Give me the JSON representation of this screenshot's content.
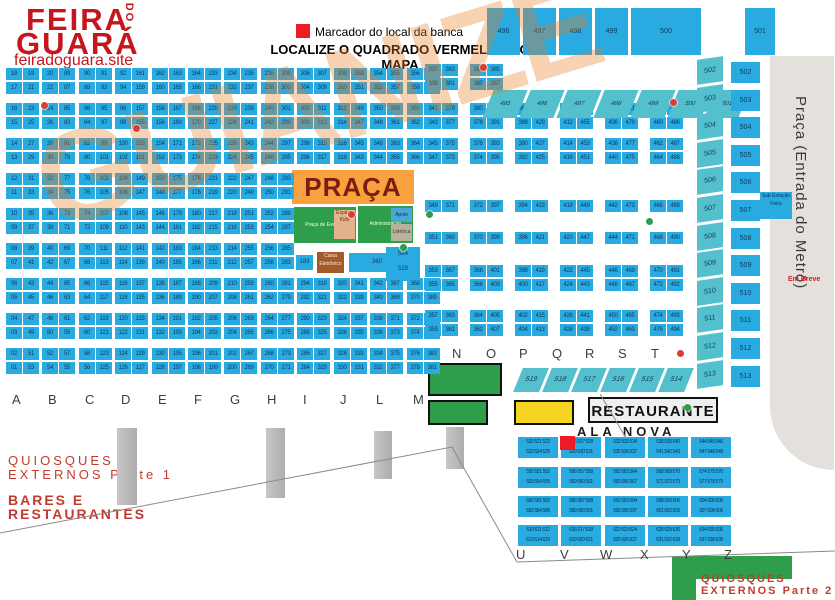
{
  "logo": {
    "line1": "FEIRA",
    "do_word": "DO",
    "line2": "GUARÁ",
    "site": "feiradoguara.site"
  },
  "legend": {
    "marker_label": "Marcador do local da banca",
    "headline": "LOCALIZE O QUADRADO VERMELHO NO MAPA"
  },
  "colors": {
    "stall_blue": "#29abe2",
    "teal": "#54c0cd",
    "praca_orange": "#f8a13e",
    "green": "#2f9e4b",
    "yellow": "#f4d522",
    "marker_red": "#ed1c24",
    "logo_red": "#c4161c",
    "footer_red": "#c23b2e",
    "metro_gray": "#e4e1dc"
  },
  "left_grid": {
    "block_ys": [
      68,
      103,
      138,
      173,
      208,
      243,
      278,
      313,
      348
    ],
    "letters_y": 392,
    "columns": [
      {
        "letter": "A",
        "x": 6,
        "split": false,
        "left": [
          "18",
          "17",
          "16",
          "15",
          "14",
          "13",
          "12",
          "11",
          "10",
          "09",
          "08",
          "07",
          "06",
          "05",
          "04",
          "03",
          "02",
          "01"
        ],
        "right": [
          "19",
          "21",
          "23",
          "25",
          "27",
          "29",
          "31",
          "33",
          "35",
          "37",
          "39",
          "41",
          "43",
          "45",
          "47",
          "49",
          "51",
          "53"
        ]
      },
      {
        "letter": "B",
        "x": 42,
        "split": false,
        "left": [
          "20",
          "22",
          "24",
          "26",
          "28",
          "30",
          "32",
          "34",
          "36",
          "38",
          "40",
          "42",
          "44",
          "46",
          "48",
          "50",
          "52",
          "54"
        ],
        "right": [
          "89",
          "87",
          "85",
          "83",
          "81",
          "79",
          "77",
          "75",
          "73",
          "71",
          "69",
          "67",
          "65",
          "63",
          "61",
          "59",
          "57",
          "55"
        ]
      },
      {
        "letter": "C",
        "x": 79,
        "split": false,
        "left": [
          "90",
          "88",
          "86",
          "84",
          "82",
          "80",
          "78",
          "76",
          "74",
          "72",
          "70",
          "68",
          "66",
          "64",
          "62",
          "60",
          "58",
          "56"
        ],
        "right": [
          "91",
          "93",
          "95",
          "97",
          "99",
          "101",
          "103",
          "105",
          "107",
          "109",
          "111",
          "113",
          "115",
          "117",
          "119",
          "121",
          "123",
          "125"
        ]
      },
      {
        "letter": "D",
        "x": 115,
        "split": false,
        "left": [
          "92",
          "94",
          "96",
          "98",
          "100",
          "102",
          "104",
          "106",
          "108",
          "110",
          "112",
          "114",
          "116",
          "118",
          "120",
          "122",
          "124",
          "126"
        ],
        "right": [
          "161",
          "159",
          "157",
          "155",
          "153",
          "151",
          "149",
          "147",
          "145",
          "143",
          "141",
          "139",
          "137",
          "135",
          "133",
          "131",
          "129",
          "127"
        ]
      },
      {
        "letter": "E",
        "x": 152,
        "split": false,
        "left": [
          "162",
          "160",
          "158",
          "156",
          "154",
          "152",
          "150",
          "148",
          "146",
          "144",
          "142",
          "140",
          "138",
          "136",
          "134",
          "132",
          "130",
          "128"
        ],
        "right": [
          "163",
          "165",
          "167",
          "169",
          "171",
          "173",
          "175",
          "177",
          "179",
          "181",
          "183",
          "185",
          "187",
          "189",
          "191",
          "193",
          "195",
          "197"
        ]
      },
      {
        "letter": "F",
        "x": 188,
        "split": false,
        "left": [
          "164",
          "166",
          "168",
          "170",
          "172",
          "174",
          "176",
          "178",
          "180",
          "182",
          "184",
          "186",
          "188",
          "190",
          "192",
          "194",
          "196",
          "198"
        ],
        "right": [
          "233",
          "231",
          "229",
          "227",
          "225",
          "223",
          "221",
          "219",
          "217",
          "215",
          "213",
          "211",
          "209",
          "207",
          "205",
          "203",
          "201",
          "199"
        ]
      },
      {
        "letter": "G",
        "x": 224,
        "split": false,
        "left": [
          "234",
          "232",
          "230",
          "228",
          "226",
          "224",
          "222",
          "220",
          "218",
          "216",
          "214",
          "212",
          "210",
          "208",
          "206",
          "204",
          "202",
          "200"
        ],
        "right": [
          "235",
          "237",
          "239",
          "241",
          "243",
          "245",
          "247",
          "249",
          "251",
          "253",
          "255",
          "257",
          "259",
          "261",
          "263",
          "265",
          "267",
          "269"
        ]
      },
      {
        "letter": "H",
        "x": 261,
        "split": false,
        "left": [
          "236",
          "238",
          "240",
          "242",
          "244",
          "246",
          "248",
          "250",
          "252",
          "254",
          "256",
          "258",
          "260",
          "262",
          "264",
          "266",
          "268",
          "270"
        ],
        "right": [
          "305",
          "303",
          "301",
          "299",
          "297",
          "295",
          "293",
          "291",
          "289",
          "287",
          "285",
          "283",
          "281",
          "279",
          "277",
          "275",
          "273",
          "271"
        ]
      },
      {
        "letter": "I",
        "x": 297,
        "split": true,
        "left": [
          "306",
          "304",
          "302",
          "300",
          "298",
          "296",
          "294",
          "292",
          "290",
          "288",
          "286",
          "284"
        ],
        "right": [
          "307",
          "309",
          "311",
          "313",
          "315",
          "317",
          "319",
          "321",
          "323",
          "325",
          "327",
          "329"
        ]
      },
      {
        "letter": "J",
        "x": 334,
        "split": true,
        "left": [
          "308",
          "310",
          "312",
          "314",
          "316",
          "318",
          "320",
          "322",
          "324",
          "326",
          "328",
          "330"
        ],
        "right": [
          "353",
          "351",
          "349",
          "347",
          "345",
          "343",
          "341",
          "339",
          "337",
          "335",
          "333",
          "331"
        ]
      },
      {
        "letter": "L",
        "x": 370,
        "split": true,
        "left": [
          "354",
          "352",
          "350",
          "348",
          "346",
          "344",
          "342",
          "340",
          "338",
          "336",
          "334",
          "332"
        ],
        "right": [
          "355",
          "357",
          "359",
          "361",
          "363",
          "365",
          "367",
          "369",
          "371",
          "373",
          "375",
          "377"
        ]
      },
      {
        "letter": "M",
        "x": 407,
        "split": true,
        "left": [
          "356",
          "358",
          "360",
          "362",
          "364",
          "366",
          "368",
          "370",
          "372",
          "374",
          "376",
          "378"
        ],
        "right": [
          "403",
          "401",
          "399",
          "397",
          "395",
          "393",
          "391",
          "389",
          "387",
          "385",
          "383",
          "381"
        ]
      }
    ]
  },
  "center_grid": {
    "rows_full": [
      64,
      78,
      103,
      117,
      138,
      152,
      200,
      232,
      265,
      279,
      310,
      324
    ],
    "rows_short": [
      103,
      117,
      138,
      152,
      200,
      232,
      265,
      279,
      310,
      324
    ],
    "letters": [
      "N",
      "O",
      "P",
      "Q",
      "R",
      "S",
      "T"
    ],
    "letters_y": 346,
    "columns": [
      {
        "x": 425,
        "size": "full",
        "left": [
          "337",
          "339",
          "341",
          "343",
          "345",
          "347",
          "349",
          "351",
          "353",
          "355",
          "357",
          "359"
        ],
        "right": [
          "383",
          "381",
          "379",
          "377",
          "375",
          "373",
          "371",
          "369",
          "367",
          "365",
          "363",
          "361"
        ]
      },
      {
        "x": 470,
        "size": "full",
        "left": [
          "384",
          "382",
          "380",
          "378",
          "376",
          "374",
          "372",
          "370",
          "368",
          "366",
          "364",
          "362"
        ],
        "right": [
          "385",
          "387",
          "389",
          "391",
          "393",
          "395",
          "397",
          "399",
          "401",
          "403",
          "405",
          "407"
        ]
      },
      {
        "x": 515,
        "size": "short",
        "left": [
          "386",
          "388",
          "390",
          "392",
          "394",
          "396",
          "398",
          "400",
          "402",
          "404"
        ],
        "right": [
          "431",
          "429",
          "427",
          "425",
          "423",
          "421",
          "419",
          "417",
          "415",
          "413"
        ]
      },
      {
        "x": 560,
        "size": "short",
        "left": [
          "410",
          "412",
          "414",
          "416",
          "418",
          "420",
          "422",
          "424",
          "426",
          "428"
        ],
        "right": [
          "457",
          "455",
          "453",
          "451",
          "449",
          "447",
          "445",
          "443",
          "441",
          "439"
        ]
      },
      {
        "x": 605,
        "size": "short",
        "left": [
          "434",
          "436",
          "438",
          "440",
          "442",
          "444",
          "446",
          "448",
          "450",
          "452"
        ],
        "right": [
          "481",
          "479",
          "477",
          "475",
          "473",
          "471",
          "469",
          "467",
          "465",
          "463"
        ]
      },
      {
        "x": 650,
        "size": "short",
        "left": [
          "458",
          "460",
          "462",
          "464",
          "466",
          "468",
          "470",
          "472",
          "474",
          "476"
        ],
        "right": [
          "485",
          "486",
          "487",
          "488",
          "489",
          "490",
          "491",
          "492",
          "493",
          "494"
        ]
      }
    ]
  },
  "top_strip": {
    "boxes": [
      "496",
      "497",
      "498",
      "499"
    ],
    "wide_box": "500",
    "tall_box": "501",
    "slanted": [
      "495",
      "496",
      "497",
      "498",
      "499",
      "500",
      "501"
    ]
  },
  "right_strips": {
    "slanted": [
      "502",
      "503",
      "504",
      "505",
      "506",
      "507",
      "508",
      "509",
      "510",
      "511",
      "512",
      "513"
    ],
    "rects": [
      "502",
      "503",
      "504",
      "505",
      "506",
      "507",
      "508",
      "509",
      "510",
      "511",
      "512",
      "513"
    ]
  },
  "mid_strip": [
    "519",
    "518",
    "517",
    "516",
    "515",
    "514"
  ],
  "metro": {
    "label": "Praça (Entrada do Metrô)",
    "em_breve": "Em Breve",
    "substation": "Sub Estação Feira"
  },
  "praca": {
    "title": "PRAÇA",
    "events_label": "Praça de Eventos",
    "kids_label": "Espaço Kids",
    "admin_label": "Administração",
    "apoio_label": "Apoio",
    "loterica_label": "Lotérica",
    "caixa_label": "Caixa Eletrônico",
    "box_a": "183",
    "box_b": "360",
    "box_c1": "524",
    "box_c2": "528"
  },
  "restaurante": {
    "label": "RESTAURANTE"
  },
  "ala_nova": {
    "title": "ALA NOVA",
    "letters": [
      "U",
      "V",
      "W",
      "X",
      "Y",
      "Z"
    ],
    "letters_y": 547,
    "col_xs": [
      518,
      561,
      605,
      648,
      691
    ],
    "row_ys": [
      437,
      467,
      496,
      525
    ],
    "boxes": [
      [
        [
          "520 521 522",
          "523 524 525"
        ],
        [
          "526 527 528",
          "529 530 531"
        ],
        [
          "532 533 534",
          "535 536 537"
        ],
        [
          "538 539 540",
          "541 542 543"
        ],
        [
          "544 545 546",
          "547 548 549"
        ]
      ],
      [
        [
          "550 551 552",
          "553 554 555"
        ],
        [
          "556 557 558",
          "559 560 561"
        ],
        [
          "562 563 564",
          "565 566 567"
        ],
        [
          "568 569 570",
          "571 572 573"
        ],
        [
          "574 575 576",
          "577 578 579"
        ]
      ],
      [
        [
          "580 581 582",
          "583 584 585"
        ],
        [
          "586 587 588",
          "589 590 591"
        ],
        [
          "592 593 594",
          "595 596 597"
        ],
        [
          "598 599 600",
          "601 602 603"
        ],
        [
          "604 605 606",
          "607 608 609"
        ]
      ],
      [
        [
          "610 611 612",
          "613 614 615"
        ],
        [
          "616 617 618",
          "619 620 621"
        ],
        [
          "622 623 624",
          "625 626 627"
        ],
        [
          "628 629 630",
          "631 632 633"
        ],
        [
          "634 635 636",
          "637 638 639"
        ]
      ]
    ]
  },
  "footer": {
    "q1_line1": "QUIOSQUES",
    "q1_line2": "EXTERNOS Parte 1",
    "bares_line1": "BARES E",
    "bares_line2": "RESTAURANTES",
    "q2_line1": "QUIOSQUES",
    "q2_line2": "EXTERNOS Parte 2"
  },
  "watermark": {
    "text": "GUIANIZE"
  },
  "dots": [
    {
      "x": 41,
      "y": 102,
      "color": "#e03c2f"
    },
    {
      "x": 133,
      "y": 125,
      "color": "#e03c2f"
    },
    {
      "x": 480,
      "y": 64,
      "color": "#e03c2f"
    },
    {
      "x": 670,
      "y": 99,
      "color": "#e03c2f"
    },
    {
      "x": 348,
      "y": 211,
      "color": "#e03c2f"
    },
    {
      "x": 677,
      "y": 350,
      "color": "#e03c2f"
    },
    {
      "x": 426,
      "y": 211,
      "color": "#2f9e4b"
    },
    {
      "x": 646,
      "y": 218,
      "color": "#2f9e4b"
    },
    {
      "x": 400,
      "y": 244,
      "color": "#2f9e4b"
    },
    {
      "x": 684,
      "y": 404,
      "color": "#2f9e4b"
    }
  ]
}
